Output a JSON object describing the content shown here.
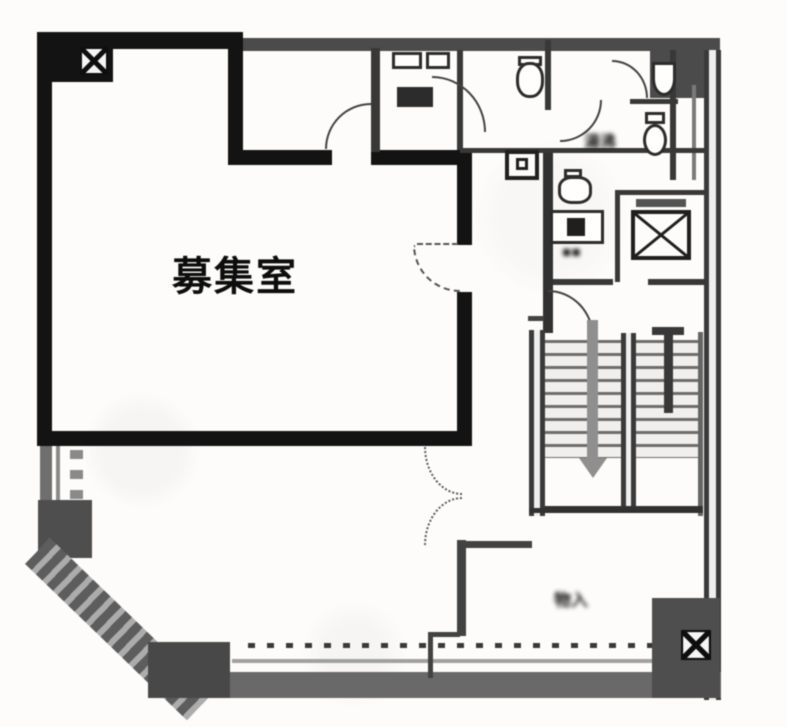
{
  "plan": {
    "type": "floor-plan",
    "rooms": {
      "vacant": {
        "label": "募集室"
      }
    },
    "annotations": {
      "utility_label_blurred": "湯沸",
      "storage_label_blurred": "物入"
    },
    "symbols": {
      "column_marker_top_left": "box-with-x-marker",
      "column_marker_bottom_right": "box-with-x-marker",
      "elevator_shaft": "box-with-x-cross",
      "stair_direction": "down-arrow"
    },
    "colors": {
      "wall_bold": "#161616",
      "wall_gray": "#4d4d4d",
      "partition": "#3a3a3a",
      "paper": "#fdfcfa",
      "arrow_gray": "#8f8f8f"
    }
  }
}
